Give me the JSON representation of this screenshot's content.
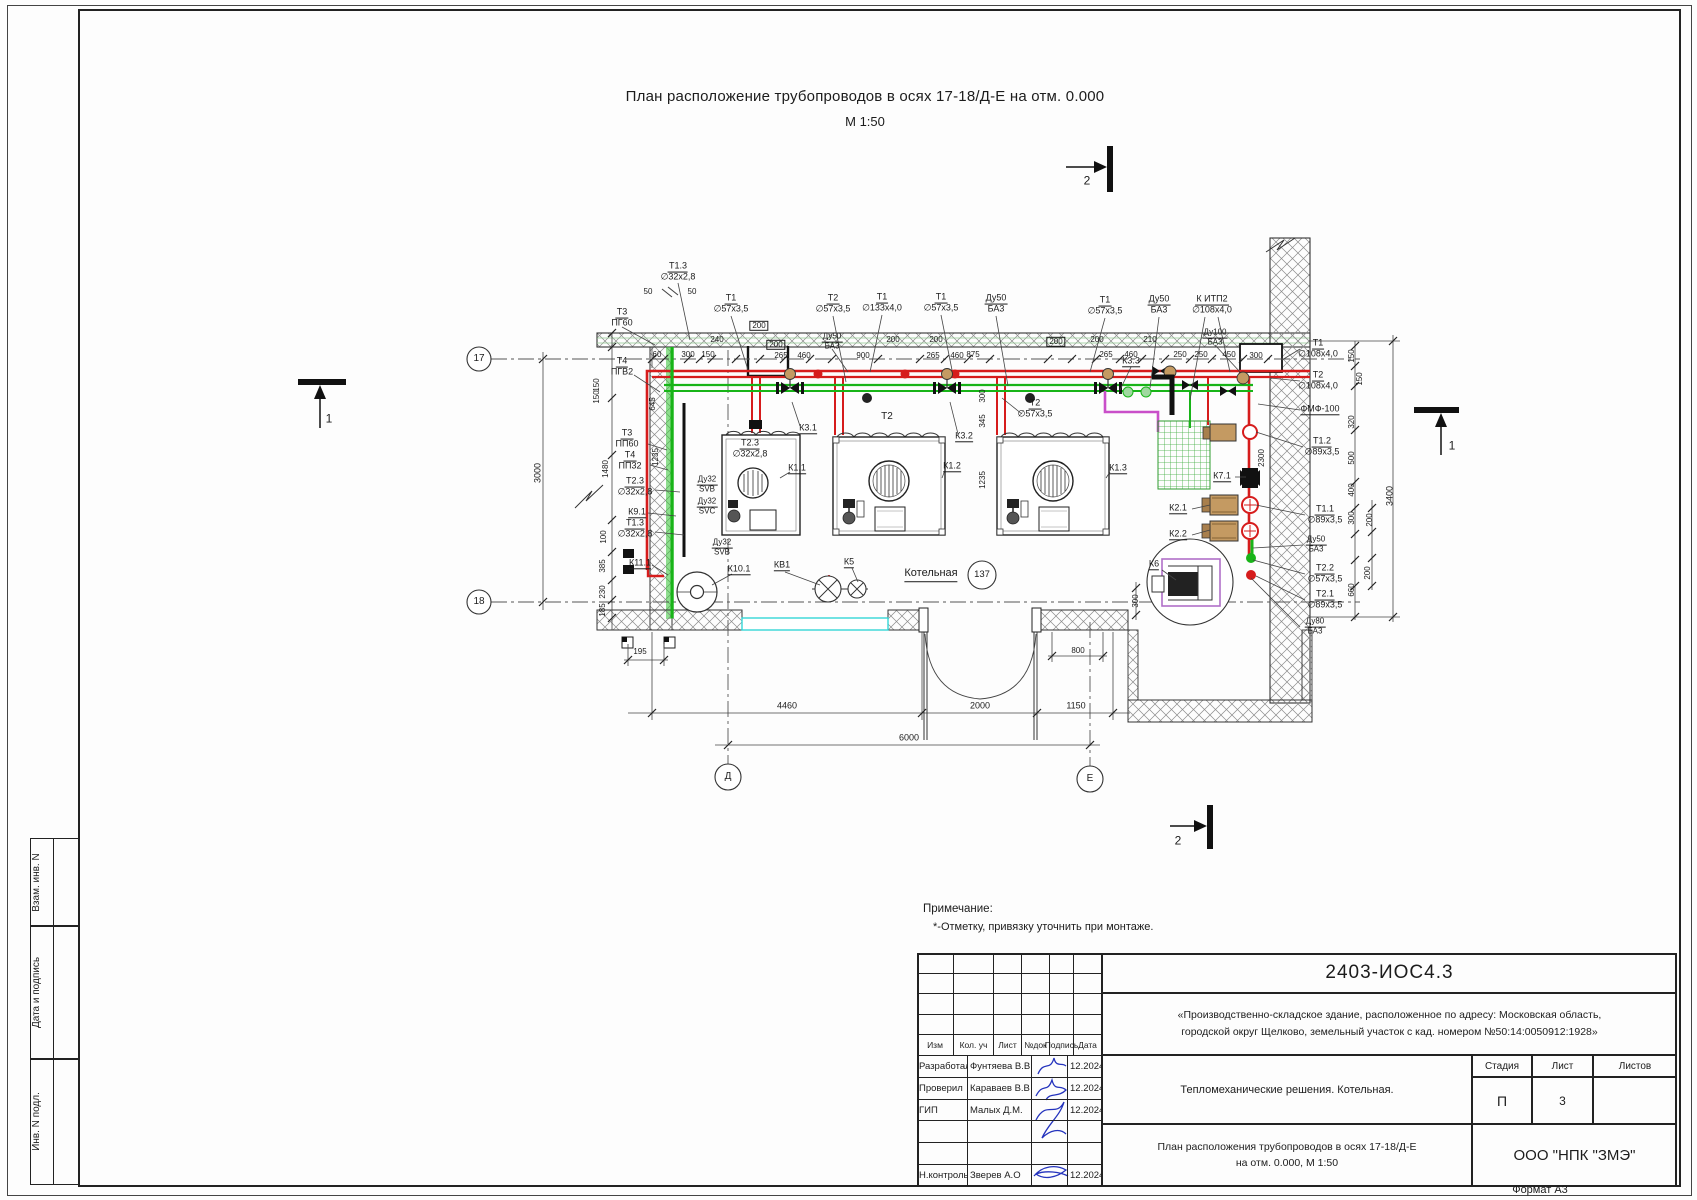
{
  "sheet": {
    "title_line1": "План расположение трубопроводов в осях 17-18/Д-Е на отм. 0.000",
    "title_line2": "М 1:50",
    "format_note": "Формат А3"
  },
  "note": {
    "heading": "Примечание:",
    "text": "*-Отметку, привязку уточнить при монтаже."
  },
  "sidebar": {
    "labels": [
      "Взам. инв. N",
      "Дата и подпись",
      "Инв. N подл."
    ]
  },
  "stamp": {
    "doc_code": "2403-ИОС4.3",
    "project_line1": "«Производственно-складское здание, расположенное по адресу: Московская область,",
    "project_line2": "городской округ Щелково, земельный участок с кад. номером №50:14:0050912:1928»",
    "section_title": "Тепломеханические решения. Котельная.",
    "sheet_title_line1": "План расположения трубопроводов в осях 17-18/Д-Е",
    "sheet_title_line2": "на отм. 0.000, М 1:50",
    "org": "ООО \"НПК \"ЗМЭ\"",
    "header_cols": [
      "Изм",
      "Кол. уч",
      "Лист",
      "№док",
      "Подпись",
      "Дата"
    ],
    "stage_cols": [
      "Стадия",
      "Лист",
      "Листов"
    ],
    "stage": "П",
    "sheet_no": "3",
    "sheets_total": "",
    "rows": [
      {
        "role": "Разработал",
        "name": "Фунтяева В.В.",
        "date": "12.2024"
      },
      {
        "role": "Проверил",
        "name": "Караваев В.В",
        "date": "12.2024"
      },
      {
        "role": "ГИП",
        "name": "Малых Д.М.",
        "date": "12.2024"
      },
      {
        "role": "",
        "name": "",
        "date": ""
      },
      {
        "role": "",
        "name": "",
        "date": ""
      },
      {
        "role": "Н.контроль",
        "name": "Зверев А.О",
        "date": "12.2024"
      }
    ]
  },
  "plan": {
    "room_label": "Котельная",
    "room_number": "137",
    "annotations": [
      {
        "t": "Т1.3|∅32х2,8",
        "x": 678,
        "y": 272,
        "f": 1
      },
      {
        "t": "Т3|ПГ60",
        "x": 622,
        "y": 318,
        "f": 1
      },
      {
        "t": "Т4|ПГВ2",
        "x": 622,
        "y": 367,
        "f": 1
      },
      {
        "t": "Т1|∅57х3,5",
        "x": 731,
        "y": 304,
        "f": 1
      },
      {
        "t": "Т2|∅57х3,5",
        "x": 833,
        "y": 304,
        "f": 1
      },
      {
        "t": "Т1|∅133х4,0",
        "x": 882,
        "y": 303,
        "f": 1
      },
      {
        "t": "Т1|∅57х3,5",
        "x": 941,
        "y": 303,
        "f": 1
      },
      {
        "t": "Ду50|БА3",
        "x": 996,
        "y": 304,
        "f": 1
      },
      {
        "t": "Т1|∅57х3,5",
        "x": 1105,
        "y": 306,
        "f": 1
      },
      {
        "t": "Ду50|БА3",
        "x": 1159,
        "y": 305,
        "f": 1
      },
      {
        "t": "К ИТП2|∅108х4,0",
        "x": 1212,
        "y": 305,
        "f": 1
      },
      {
        "t": "Ду100|БА3",
        "x": 1215,
        "y": 338,
        "f": 1,
        "s": 8
      },
      {
        "t": "Ду50|БА3",
        "x": 832,
        "y": 342,
        "f": 1,
        "s": 8
      },
      {
        "t": "Т1|∅108х4,0",
        "x": 1318,
        "y": 349,
        "f": 1
      },
      {
        "t": "Т2|∅108х4,0",
        "x": 1318,
        "y": 381,
        "f": 1
      },
      {
        "t": "Т1.2|∅89х3,5",
        "x": 1322,
        "y": 447,
        "f": 1
      },
      {
        "t": "Т1.1|∅89х3,5",
        "x": 1325,
        "y": 515,
        "f": 1
      },
      {
        "t": "Ду50|БА3",
        "x": 1316,
        "y": 545,
        "f": 1,
        "s": 8
      },
      {
        "t": "Т2.2|∅57х3,5",
        "x": 1325,
        "y": 574,
        "f": 1
      },
      {
        "t": "Т2.1|∅89х3,5",
        "x": 1325,
        "y": 600,
        "f": 1
      },
      {
        "t": "Ду80|БА3",
        "x": 1315,
        "y": 627,
        "f": 1,
        "s": 8
      },
      {
        "t": "Т3|ПП60",
        "x": 627,
        "y": 439,
        "f": 1
      },
      {
        "t": "Т4|ПП32",
        "x": 630,
        "y": 461,
        "f": 1
      },
      {
        "t": "Т2.3|∅32х2,8",
        "x": 635,
        "y": 487,
        "f": 1
      },
      {
        "t": "Т1.3|∅32х2,8",
        "x": 635,
        "y": 529,
        "f": 1
      },
      {
        "t": "Ду32|SVB",
        "x": 707,
        "y": 485,
        "f": 1,
        "s": 8
      },
      {
        "t": "Ду32|SVC",
        "x": 707,
        "y": 507,
        "f": 1,
        "s": 8
      },
      {
        "t": "Ду32|SVB",
        "x": 722,
        "y": 548,
        "f": 1,
        "s": 8
      },
      {
        "t": "Т2.3|∅32х2,8",
        "x": 750,
        "y": 449,
        "f": 1
      },
      {
        "t": "Т2|∅57х3,5",
        "x": 1035,
        "y": 409,
        "f": 1
      },
      {
        "t": "ФМФ-100",
        "x": 1320,
        "y": 410,
        "u": 1
      },
      {
        "t": "К9.1",
        "x": 637,
        "y": 513,
        "u": 1
      },
      {
        "t": "К11.1",
        "x": 640,
        "y": 564,
        "u": 1
      },
      {
        "t": "К10.1",
        "x": 739,
        "y": 570,
        "u": 1
      },
      {
        "t": "КВ1",
        "x": 782,
        "y": 566,
        "u": 1
      },
      {
        "t": "К5",
        "x": 849,
        "y": 563,
        "u": 1
      },
      {
        "t": "К1.1",
        "x": 797,
        "y": 469,
        "u": 1
      },
      {
        "t": "К3.1",
        "x": 808,
        "y": 429,
        "u": 1
      },
      {
        "t": "К1.2",
        "x": 952,
        "y": 467,
        "u": 1
      },
      {
        "t": "К3.2",
        "x": 964,
        "y": 437,
        "u": 1
      },
      {
        "t": "К1.3",
        "x": 1118,
        "y": 469,
        "u": 1
      },
      {
        "t": "К3.3",
        "x": 1131,
        "y": 362,
        "u": 1
      },
      {
        "t": "К7.1",
        "x": 1222,
        "y": 477,
        "u": 1
      },
      {
        "t": "К2.1",
        "x": 1178,
        "y": 509,
        "u": 1
      },
      {
        "t": "К2.2",
        "x": 1178,
        "y": 535,
        "u": 1
      },
      {
        "t": "К6",
        "x": 1154,
        "y": 565,
        "u": 1
      },
      {
        "t": "Котельная",
        "x": 931,
        "y": 575,
        "u": 1,
        "s": 11
      },
      {
        "t": "Т2",
        "x": 887,
        "y": 417,
        "s": 10
      },
      {
        "t": "137",
        "x": 982,
        "y": 575,
        "s": 9.5
      },
      {
        "t": "17",
        "x": 479,
        "y": 359,
        "s": 10
      },
      {
        "t": "18",
        "x": 479,
        "y": 602,
        "s": 10
      },
      {
        "t": "Д",
        "x": 728,
        "y": 777,
        "s": 10
      },
      {
        "t": "Е",
        "x": 1090,
        "y": 779,
        "s": 10
      },
      {
        "t": "2",
        "x": 1087,
        "y": 181,
        "s": 12
      },
      {
        "t": "2",
        "x": 1178,
        "y": 841,
        "s": 12
      },
      {
        "t": "1",
        "x": 329,
        "y": 419,
        "s": 12
      },
      {
        "t": "1",
        "x": 1452,
        "y": 446,
        "s": 12
      },
      {
        "t": "50",
        "x": 648,
        "y": 292,
        "s": 8
      },
      {
        "t": "50",
        "x": 692,
        "y": 292,
        "s": 8
      },
      {
        "t": "60",
        "x": 657,
        "y": 355,
        "s": 8
      },
      {
        "t": "300",
        "x": 688,
        "y": 355,
        "s": 8
      },
      {
        "t": "150",
        "x": 708,
        "y": 355,
        "s": 8
      },
      {
        "t": "240",
        "x": 717,
        "y": 340,
        "s": 8
      },
      {
        "t": "200",
        "x": 759,
        "y": 326,
        "s": 8,
        "b": 1
      },
      {
        "t": "200",
        "x": 776,
        "y": 345,
        "s": 8,
        "b": 1
      },
      {
        "t": "265",
        "x": 781,
        "y": 356,
        "s": 8
      },
      {
        "t": "460",
        "x": 804,
        "y": 356,
        "s": 8
      },
      {
        "t": "900",
        "x": 863,
        "y": 356,
        "s": 8
      },
      {
        "t": "200",
        "x": 893,
        "y": 340,
        "s": 8
      },
      {
        "t": "200",
        "x": 936,
        "y": 340,
        "s": 8
      },
      {
        "t": "265",
        "x": 933,
        "y": 356,
        "s": 8
      },
      {
        "t": "460",
        "x": 957,
        "y": 356,
        "s": 8
      },
      {
        "t": "875",
        "x": 973,
        "y": 355,
        "s": 8
      },
      {
        "t": "200",
        "x": 1056,
        "y": 342,
        "s": 8,
        "b": 1
      },
      {
        "t": "200",
        "x": 1097,
        "y": 340,
        "s": 8
      },
      {
        "t": "265",
        "x": 1106,
        "y": 355,
        "s": 8
      },
      {
        "t": "460",
        "x": 1131,
        "y": 355,
        "s": 8
      },
      {
        "t": "210",
        "x": 1150,
        "y": 340,
        "s": 8
      },
      {
        "t": "250",
        "x": 1180,
        "y": 355,
        "s": 8
      },
      {
        "t": "250",
        "x": 1201,
        "y": 355,
        "s": 8
      },
      {
        "t": "450",
        "x": 1229,
        "y": 355,
        "s": 8
      },
      {
        "t": "300",
        "x": 1256,
        "y": 356,
        "s": 8
      },
      {
        "t": "195",
        "x": 640,
        "y": 652,
        "s": 8
      },
      {
        "t": "800",
        "x": 1078,
        "y": 651,
        "s": 8
      },
      {
        "t": "4460",
        "x": 787,
        "y": 706,
        "s": 9
      },
      {
        "t": "2000",
        "x": 980,
        "y": 706,
        "s": 9
      },
      {
        "t": "1150",
        "x": 1076,
        "y": 706,
        "s": 9
      },
      {
        "t": "6000",
        "x": 909,
        "y": 738,
        "s": 9
      },
      {
        "t": "150",
        "x": 597,
        "y": 385,
        "r": -90,
        "s": 8
      },
      {
        "t": "150",
        "x": 597,
        "y": 397,
        "r": -90,
        "s": 8
      },
      {
        "t": "1480",
        "x": 606,
        "y": 469,
        "r": -90,
        "s": 8
      },
      {
        "t": "100",
        "x": 604,
        "y": 537,
        "r": -90,
        "s": 8
      },
      {
        "t": "385",
        "x": 603,
        "y": 566,
        "r": -90,
        "s": 8
      },
      {
        "t": "230",
        "x": 603,
        "y": 592,
        "r": -90,
        "s": 8
      },
      {
        "t": "185",
        "x": 603,
        "y": 610,
        "r": -90,
        "s": 8
      },
      {
        "t": "3000",
        "x": 538,
        "y": 473,
        "r": -90,
        "s": 9
      },
      {
        "t": "645",
        "x": 653,
        "y": 404,
        "r": -90,
        "s": 8
      },
      {
        "t": "1235",
        "x": 656,
        "y": 457,
        "r": -90,
        "s": 8
      },
      {
        "t": "300",
        "x": 983,
        "y": 396,
        "r": -90,
        "s": 8
      },
      {
        "t": "345",
        "x": 983,
        "y": 421,
        "r": -90,
        "s": 8
      },
      {
        "t": "1235",
        "x": 983,
        "y": 480,
        "r": -90,
        "s": 8
      },
      {
        "t": "2300",
        "x": 1262,
        "y": 458,
        "r": -90,
        "s": 8
      },
      {
        "t": "150",
        "x": 1352,
        "y": 356,
        "r": -90,
        "s": 8
      },
      {
        "t": "150",
        "x": 1360,
        "y": 379,
        "r": -90,
        "s": 8
      },
      {
        "t": "320",
        "x": 1352,
        "y": 422,
        "r": -90,
        "s": 8
      },
      {
        "t": "500",
        "x": 1352,
        "y": 458,
        "r": -90,
        "s": 8
      },
      {
        "t": "400",
        "x": 1352,
        "y": 490,
        "r": -90,
        "s": 8
      },
      {
        "t": "300",
        "x": 1352,
        "y": 518,
        "r": -90,
        "s": 8
      },
      {
        "t": "200",
        "x": 1370,
        "y": 520,
        "r": -90,
        "s": 8
      },
      {
        "t": "200",
        "x": 1368,
        "y": 573,
        "r": -90,
        "s": 8
      },
      {
        "t": "660",
        "x": 1352,
        "y": 590,
        "r": -90,
        "s": 8
      },
      {
        "t": "3400",
        "x": 1390,
        "y": 496,
        "r": -90,
        "s": 9
      },
      {
        "t": "300",
        "x": 1136,
        "y": 601,
        "r": -90,
        "s": 8
      }
    ]
  },
  "colors": {
    "pipe_supply": "#d61c1c",
    "pipe_return": "#18b418",
    "pipe_special": "#c94fc9",
    "channel": "#35d6d6",
    "pump_body": "#c49a62",
    "signature": "#2433bd"
  }
}
